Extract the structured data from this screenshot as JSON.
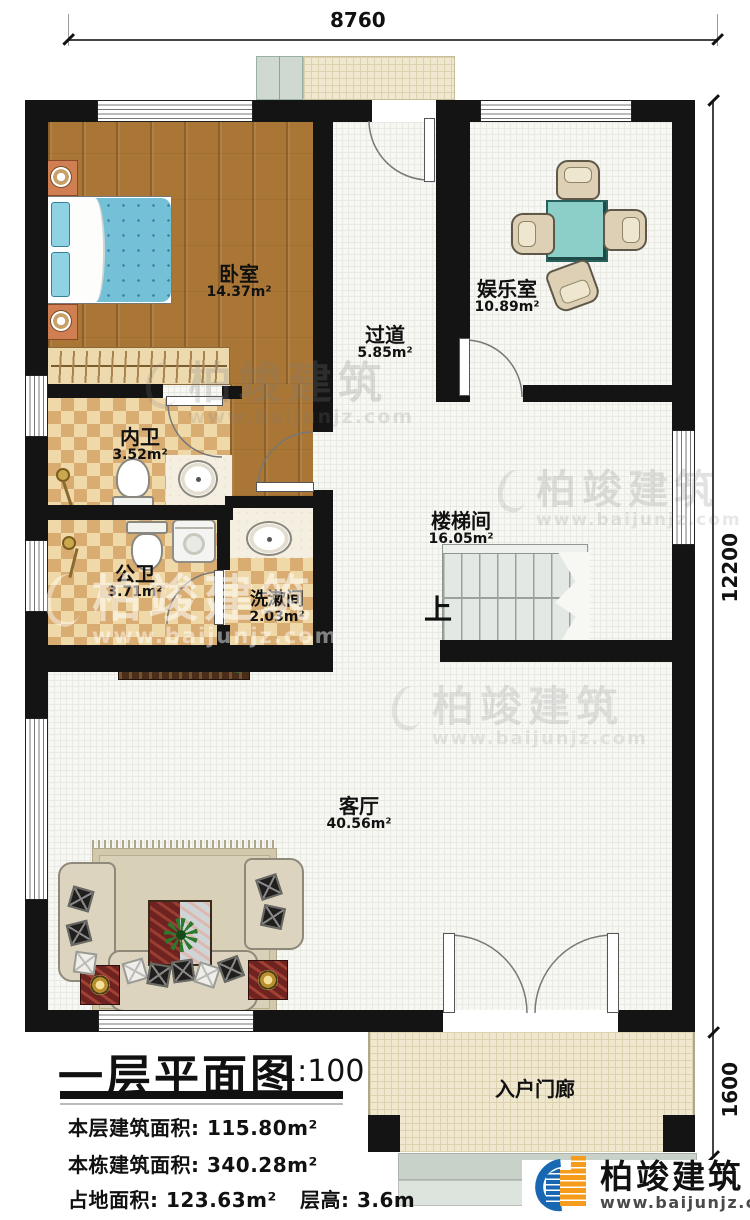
{
  "plan": {
    "rooms": {
      "bedroom": {
        "name": "卧室",
        "area": "14.37m²"
      },
      "corridor": {
        "name": "过道",
        "area": "5.85m²"
      },
      "entertainment_room": {
        "name": "娱乐室",
        "area": "10.89m²"
      },
      "ensuite_bathroom": {
        "name": "内卫",
        "area": "3.52m²"
      },
      "public_bathroom": {
        "name": "公卫",
        "area": "3.71m²"
      },
      "washroom": {
        "name": "洗漱间",
        "area": "2.03m²"
      },
      "stairwell": {
        "name": "楼梯间",
        "area": "16.05m²"
      },
      "living_room": {
        "name": "客厅",
        "area": "40.56m²"
      },
      "entry_porch": {
        "name": "入户门廊"
      }
    },
    "stairs_up_label": "上",
    "dimensions": {
      "top_width": "8760",
      "right_height": "12200",
      "porch_depth": "1600"
    }
  },
  "title_block": {
    "title": "一层平面图",
    "scale": "1:100",
    "stats": [
      "本层建筑面积: 115.80m²",
      "本栋建筑面积: 340.28m²",
      "占地面积: 123.63m²",
      "层高: 3.6m"
    ]
  },
  "branding": {
    "company": "柏竣建筑",
    "website": "www.baijunjz.com"
  },
  "watermark": {
    "text": "柏竣建筑",
    "url": "www.baijunjz.com"
  },
  "colors": {
    "wall": "#141414",
    "wood_floor": "#a97636",
    "table_teal": "#8ccfc9",
    "logo_blue": "#1767b2",
    "logo_orange": "#f59c1c"
  }
}
